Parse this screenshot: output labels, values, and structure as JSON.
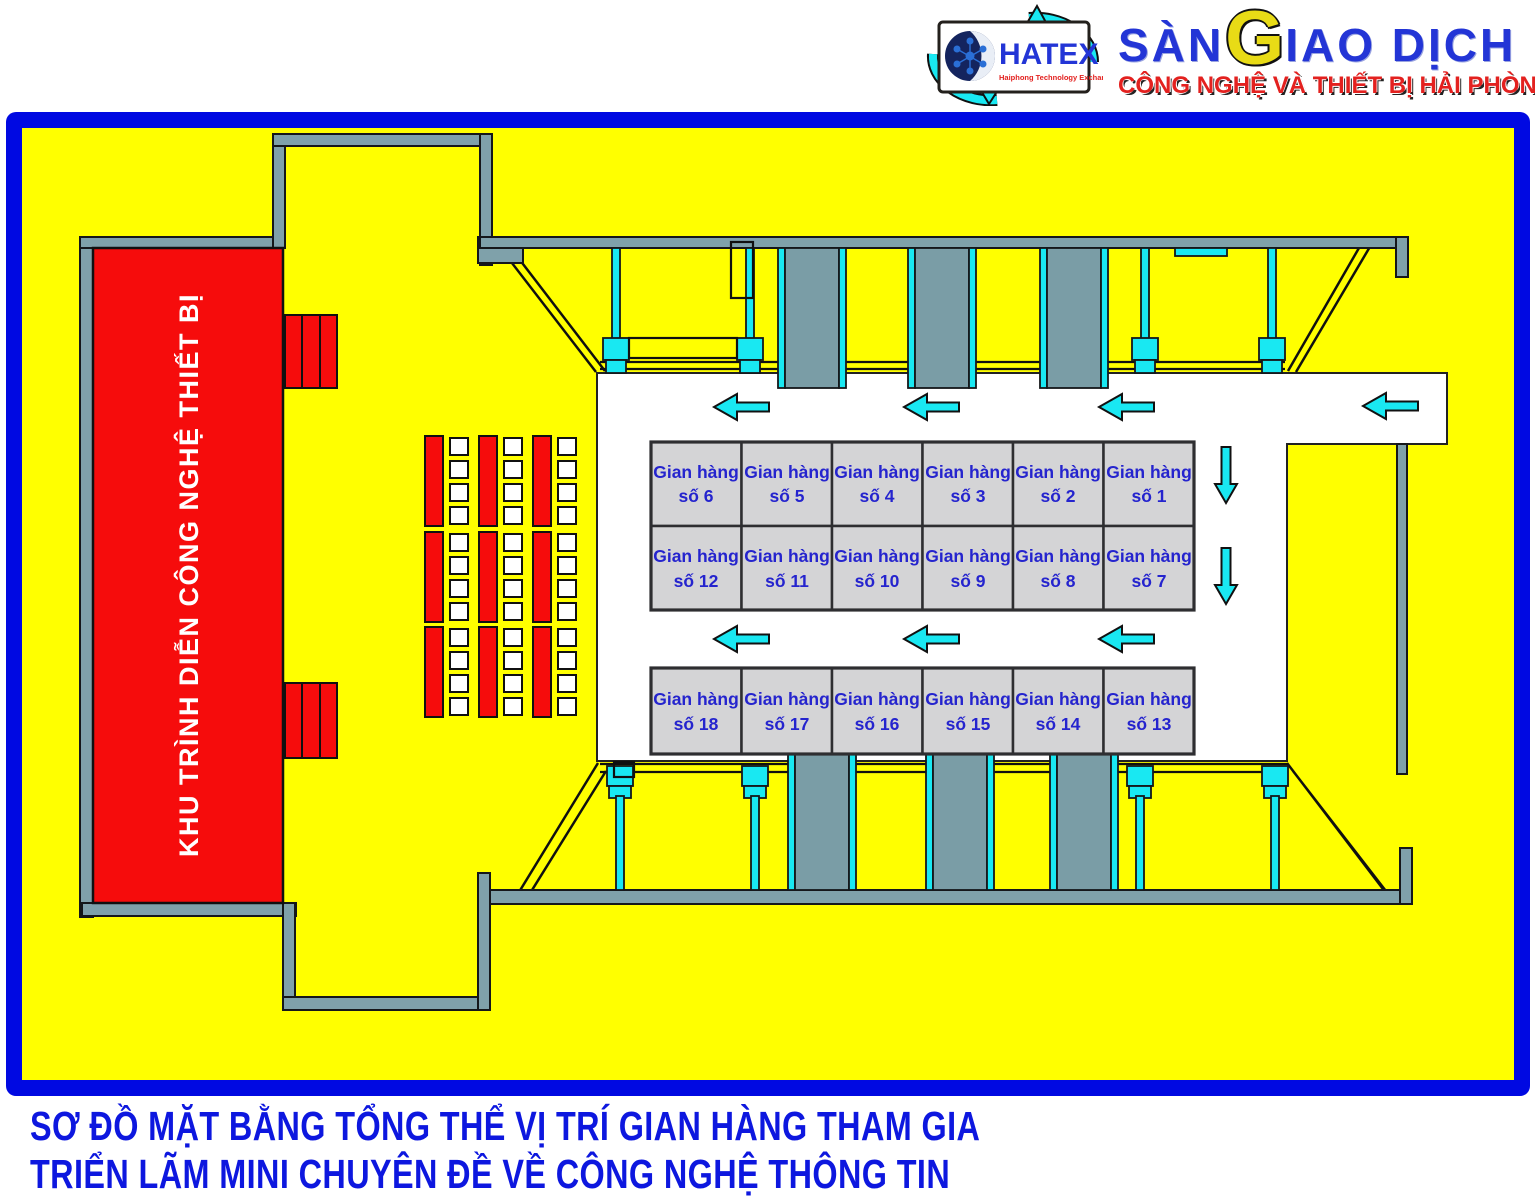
{
  "header": {
    "hatex": {
      "name": "HATEX",
      "tagline": "Haiphong Technology Exchange"
    },
    "brand": {
      "part1": "SÀN",
      "g_letter": "G",
      "part2": "IAO DỊCH",
      "subtitle": "CÔNG NGHỆ VÀ THIẾT BỊ HẢI PHÒNG"
    }
  },
  "plan": {
    "stage_label": "KHU TRÌNH DIỄN CÔNG NGHỆ THIẾT BỊ",
    "booth_prefix": "Gian hàng",
    "booth_rows": [
      [
        "số 6",
        "số 5",
        "số 4",
        "số 3",
        "số 2",
        "số 1"
      ],
      [
        "số 12",
        "số 11",
        "số 10",
        "số 9",
        "số 8",
        "số 7"
      ],
      [
        "số 18",
        "số 17",
        "số 16",
        "số 15",
        "số 14",
        "số 13"
      ]
    ]
  },
  "caption": {
    "line1": "SƠ ĐỒ MẶT BẰNG TỔNG THỂ VỊ TRÍ GIAN HÀNG THAM GIA",
    "line2": "TRIỂN LÃM MINI CHUYÊN ĐỀ VỀ CÔNG NGHỆ THÔNG TIN"
  },
  "colors": {
    "frame_blue": "#0009E2",
    "floor_yellow": "#FFFF00",
    "stage_red": "#F60C0C",
    "wall_gray": "#7FA1AA",
    "booth_gray": "#D4D4D6",
    "arrow_cyan": "#19E8F2",
    "booth_text_blue": "#2524CE",
    "caption_blue": "#0D17DF",
    "brand_blue": "#2335D6",
    "brand_yellow": "#E8DB16",
    "subtitle_red": "#E3211F"
  }
}
